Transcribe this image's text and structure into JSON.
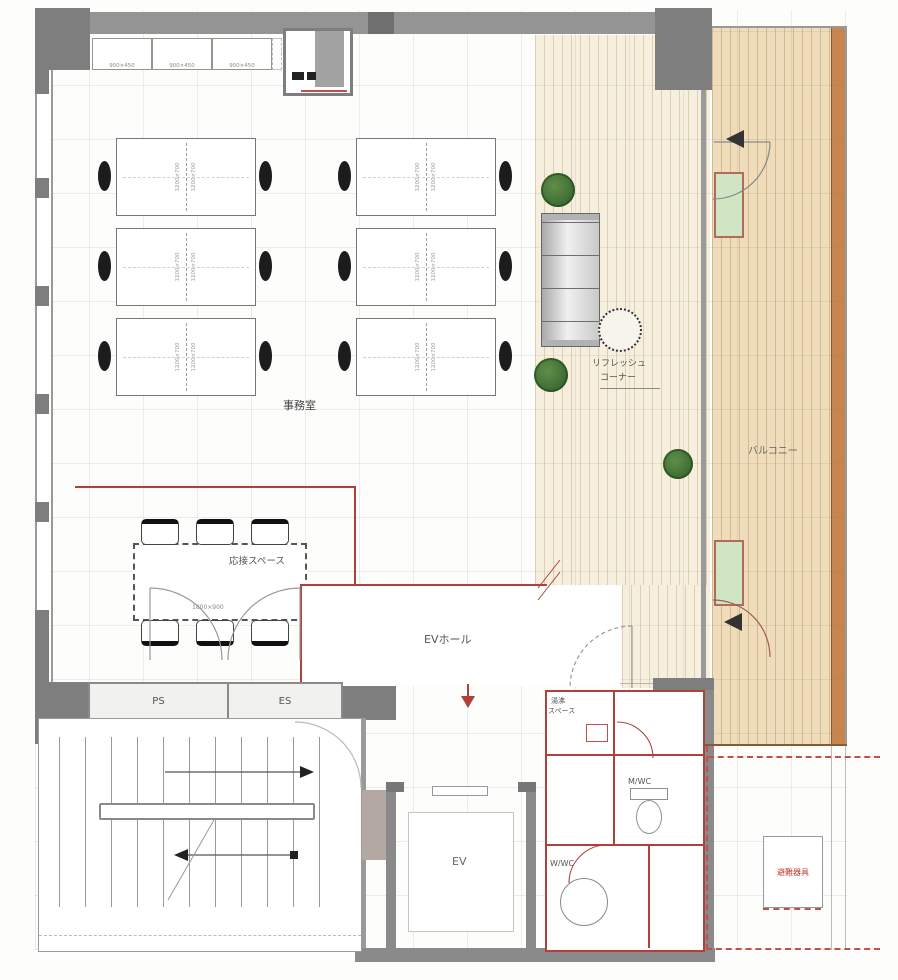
{
  "plan": {
    "type": "architectural-floor-plan",
    "rooms": {
      "office": "事務室",
      "refresh_corner": [
        "リフレッシュ",
        "コーナー"
      ],
      "balcony": "バルコニー",
      "reception_space": "応接スペース",
      "ev_hall": "EVホール",
      "pipe_space": "PS",
      "electric_space": "ES",
      "elevator": "EV",
      "kitchenette": [
        "湯沸",
        "スペース"
      ],
      "mens_wc": "M/WC",
      "womens_wc": "W/WC",
      "evacuation_equipment": "避難器具"
    },
    "dimensions": {
      "cabinet": "900×450",
      "desk": "1200×700",
      "reception_table": "1800×900"
    },
    "colors": {
      "wall_gray": "#8a8a8a",
      "wood_floor": "#f6efde",
      "balcony_floor": "#eedcba",
      "balcony_edge": "#c8854e",
      "red_line": "#b0413a",
      "plant_green": "#3f6f33",
      "window_panel_green": "#cfe5c4"
    }
  }
}
